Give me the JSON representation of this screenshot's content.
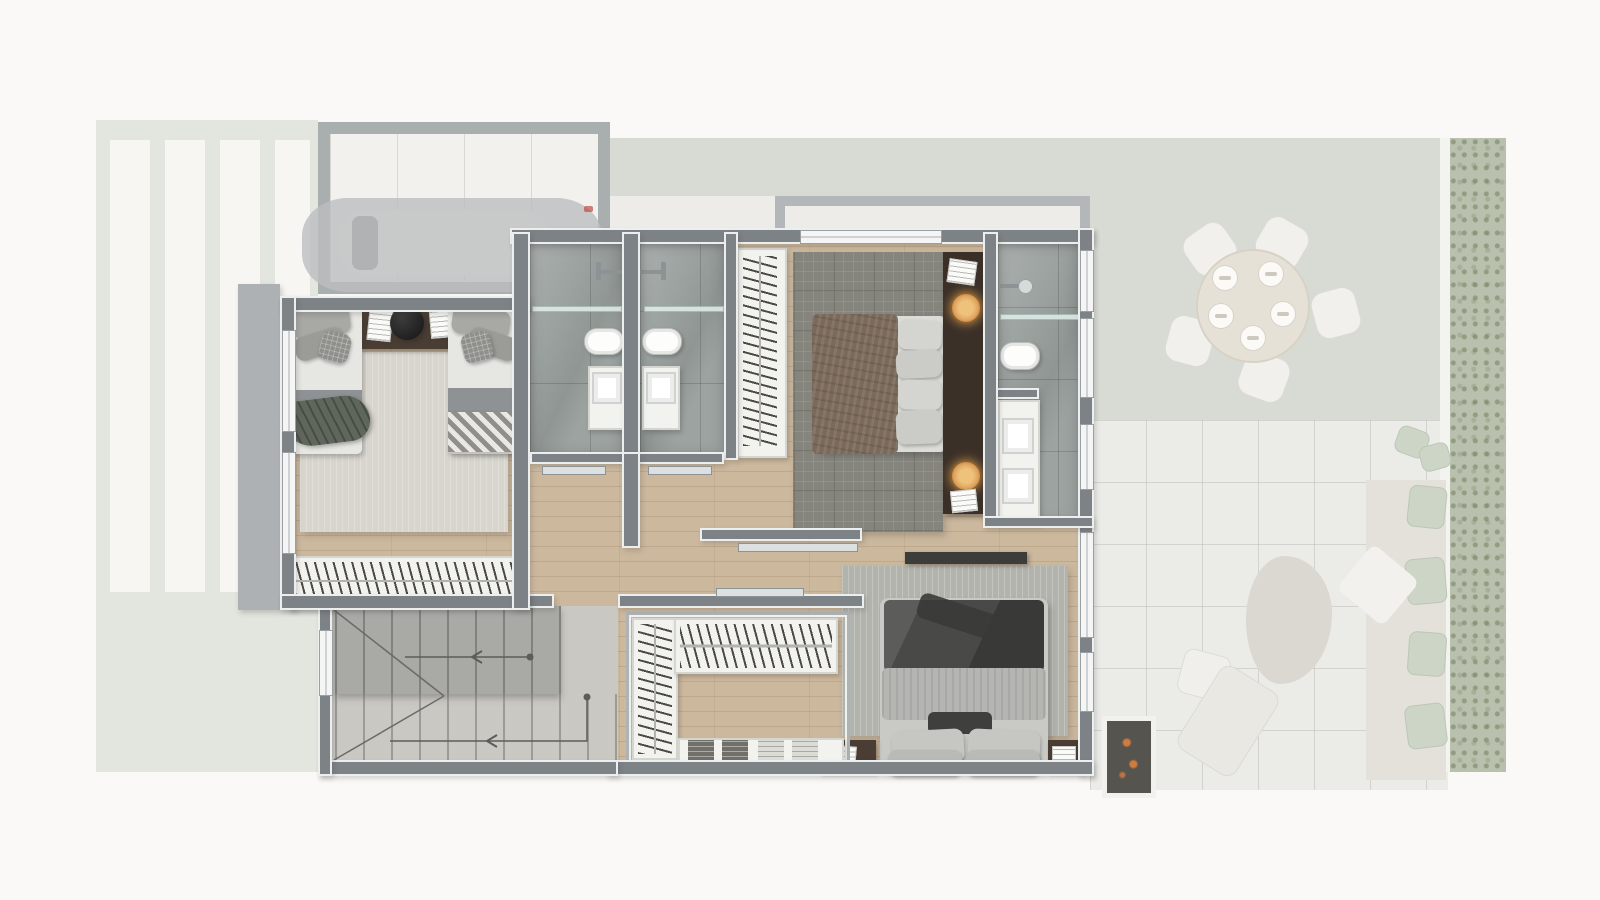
{
  "scene": {
    "type": "architectural top-down floor plan rendering",
    "description": "furnished upper-floor plan shown sharp, ground-floor surroundings (driveway, garage with car, garden, patio, outdoor dining) shown faded",
    "visible_text": "none"
  },
  "colors": {
    "page-bg": "#faf9f7",
    "wood": "#ccb89d",
    "marble": "#9da3a1",
    "wall": "#7d8287",
    "wall-casing": "#edeeee",
    "concrete": "#c9c8c3",
    "flight-upper": "#a9a9a5",
    "rug-twin": "#d8d5cd",
    "rug-master": "#85847d",
    "rug-bedroom3": "#b3b3ad",
    "headboard-wood": "#3b3028",
    "nightstand-wood": "#4a3d33",
    "lamp-amber": "#e0a55e",
    "duvet-brown": "#7b6a5a",
    "blanket-charcoal": "#494947",
    "duvet-gray": "#b5b6b2",
    "white-furniture": "#f2f2ef",
    "driveway": "#e3e5de",
    "stripe-white": "#f7f6f3",
    "lawn": "#d8dad3",
    "patio-tile": "#ebebe8",
    "hedge-green": "#b9c1ac",
    "sage-cushion": "#ccd5c6",
    "ember-orange": "#d97a35",
    "ghost-gray": "#bcbec0"
  },
  "ground_floor_ghost": {
    "driveway": {
      "finish": "striped paving",
      "stripe_count": 5
    },
    "garage": {
      "contents": "parked car, faded"
    },
    "outdoor_dining": {
      "table": "round",
      "chairs": 5,
      "place_settings": 5
    },
    "patio": {
      "furniture": [
        "sofa mat with sage cushions",
        "organic shaped rug",
        "lounge chair",
        "side table",
        "throw blanket",
        "bbq grill with glowing embers",
        "scatter pillows"
      ]
    },
    "garden": {
      "edge": "tall green hedge strip with narrow path"
    }
  },
  "upper_floor": {
    "rooms": [
      {
        "name": "twin bedroom",
        "furniture": [
          "single bed x2",
          "shared nightstand with black lamp and books",
          "area rug",
          "full-width wardrobe rack with hanging clothes",
          "balcony ledge",
          "two windows"
        ]
      },
      {
        "name": "bathroom 1",
        "fixtures": [
          "shower head",
          "glass shelf",
          "toilet",
          "vanity sink",
          "sliding door"
        ]
      },
      {
        "name": "bathroom 2",
        "fixtures": [
          "shower head",
          "glass shelf",
          "toilet",
          "vanity sink",
          "sliding door"
        ]
      },
      {
        "name": "master closet",
        "furniture": [
          "hanging rack with clothes"
        ]
      },
      {
        "name": "master bedroom",
        "furniture": [
          "double bed with brown duvet",
          "dark wood headboard console",
          "two amber pendant lamps",
          "books",
          "plaid rug",
          "sliding door"
        ]
      },
      {
        "name": "en-suite bathroom",
        "fixtures": [
          "shower head",
          "glass shelf",
          "toilet",
          "double vanity with two sinks"
        ]
      },
      {
        "name": "bedroom 3",
        "furniture": [
          "double bed with charcoal blanket and gray duvet",
          "four pillows plus lumbar pillow",
          "striped rug",
          "nightstand x2",
          "walk-in closet L-rack with hanging clothes",
          "dresser with four folded-clothes stacks",
          "dark tv console"
        ]
      },
      {
        "name": "staircase",
        "details": [
          "two flights",
          "winder treads",
          "guide lines with direction arrows and start dots"
        ]
      },
      {
        "name": "hallway",
        "details": [
          "oak plank flooring",
          "pocket doors"
        ]
      }
    ]
  }
}
